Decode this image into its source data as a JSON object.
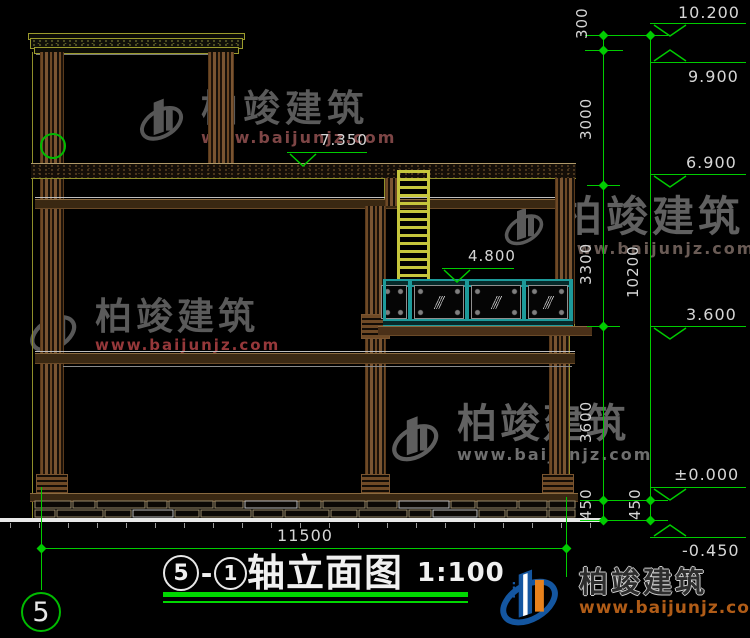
{
  "title": {
    "bubble_left": "5",
    "dash": "-",
    "bubble_right": "1",
    "name": "轴立面图",
    "scale": "1:100"
  },
  "axis_bubble": {
    "label": "5"
  },
  "dims": {
    "seg_300": "300",
    "seg_3000": "3000",
    "seg_3300": "3300",
    "seg_3600": "3600",
    "seg_450_inner": "450",
    "seg_450_outer": "450",
    "overall_10200": "10200",
    "total_width": "11500"
  },
  "elevations": {
    "roof_top": "10.200",
    "roof_eave": "9.900",
    "penthouse_floor": "7.350",
    "upper_roof": "6.900",
    "terrace_rail": "4.800",
    "terrace_floor": "3.600",
    "ground_zero": "±0.000",
    "site_level": "-0.450"
  },
  "watermark": {
    "brand": "柏竣建筑",
    "url": "www.baijunjz.com"
  },
  "footer_logo": {
    "brand": "柏竣建筑",
    "url": "www.baijunjz.com"
  },
  "colors": {
    "background": "#000000",
    "dimension_green": "#00cc00",
    "text_light": "#d6d6d6",
    "ladder_yellow": "#c6c63c",
    "railing_teal": "#1d9a9a",
    "column_brown": "#6f4a26",
    "watermark_gray": "#5d5d5d",
    "watermark_red": "#96383a",
    "logo_blue": "#1456a0",
    "logo_orange": "#e8821c"
  }
}
